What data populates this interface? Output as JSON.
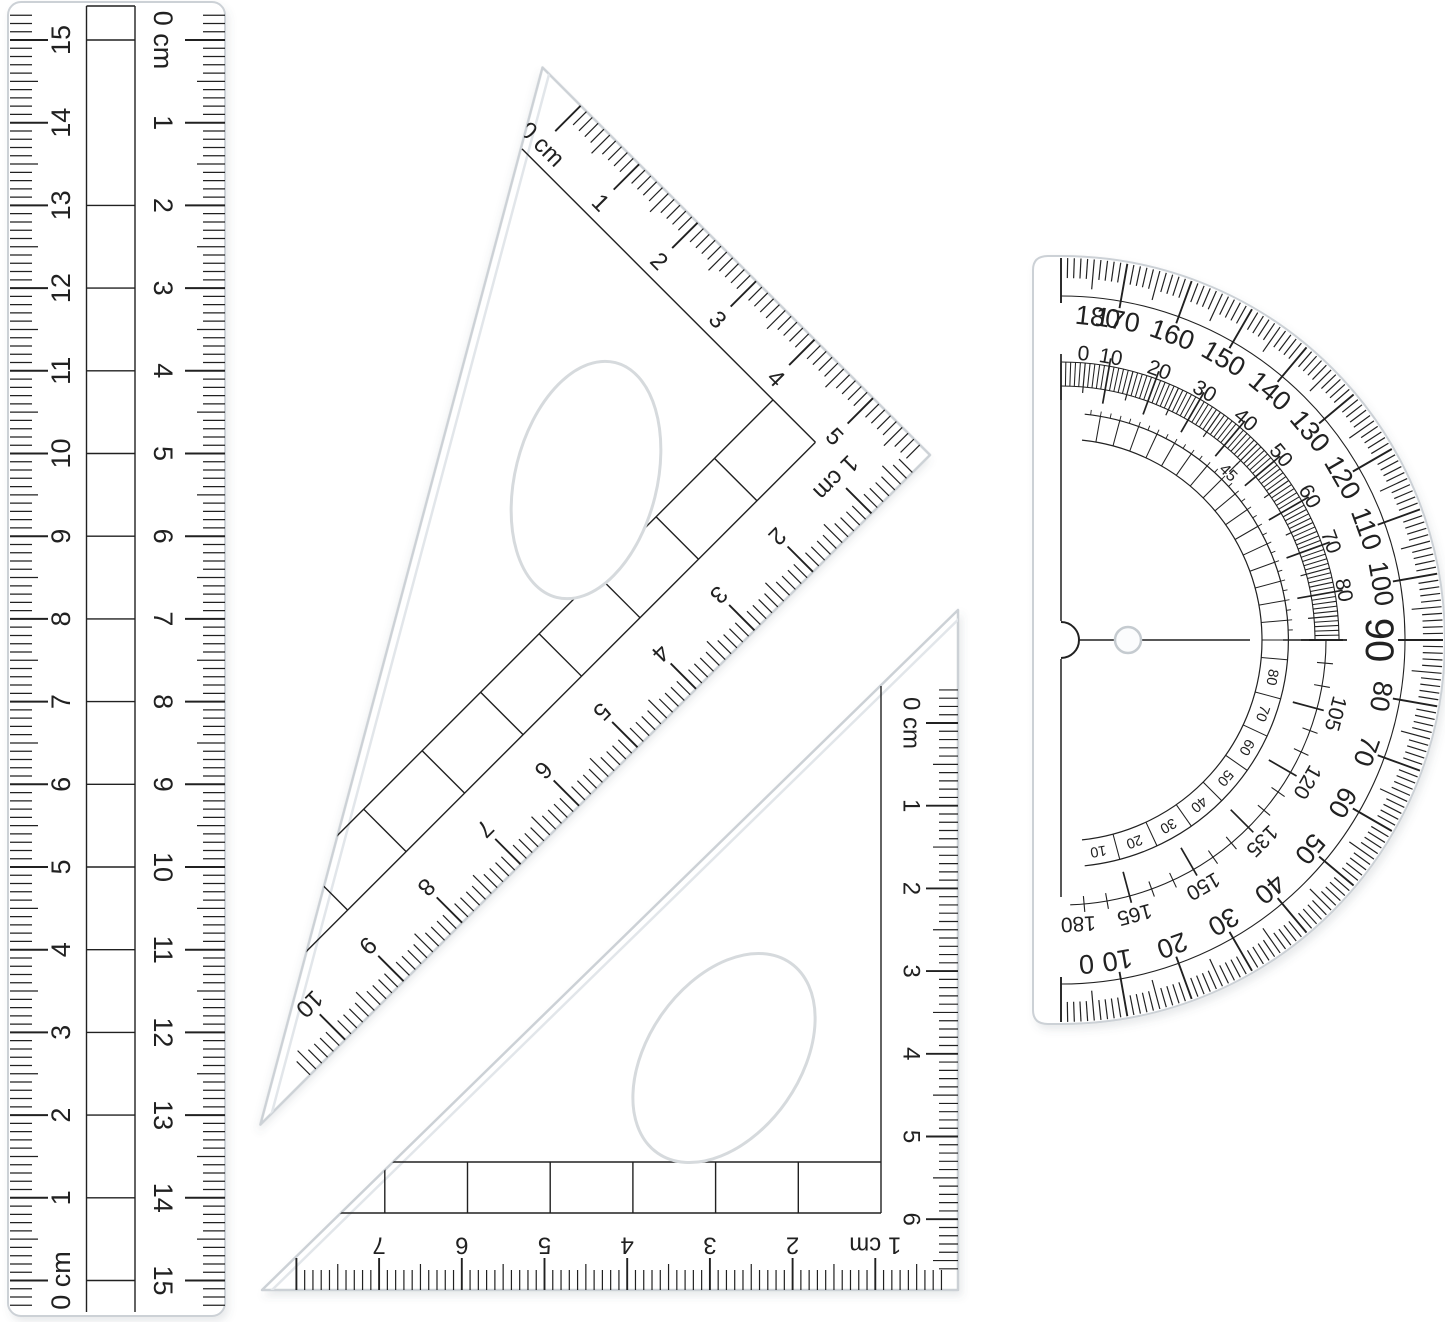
{
  "scene": {
    "type": "product-photo-geometry-set",
    "background": "#ffffff",
    "objects": [
      "ruler-15cm",
      "set-square-30-60",
      "set-square-45",
      "protractor-180"
    ]
  },
  "colors": {
    "marking": "#212121",
    "plastic_edge": "#ccd1d6",
    "bevel": "#e2e6ea",
    "hole_ring": "#c5cbd0",
    "shadow": "#5a6570"
  },
  "ruler": {
    "length_cm": 15,
    "scale_left_labels": [
      "15",
      "14",
      "13",
      "12",
      "11",
      "10",
      "9",
      "8",
      "7",
      "6",
      "5",
      "4",
      "3",
      "2",
      "1",
      "0 cm"
    ],
    "scale_right_labels": [
      "0 cm",
      "1",
      "2",
      "3",
      "4",
      "5",
      "6",
      "7",
      "8",
      "9",
      "10",
      "11",
      "12",
      "13",
      "14",
      "15"
    ]
  },
  "set_square_30_60": {
    "short_edge_labels": [
      "0 cm",
      "1",
      "2",
      "3",
      "4",
      "5"
    ],
    "long_edge_labels": [
      "1 cm",
      "2",
      "3",
      "4",
      "5",
      "6",
      "7",
      "8",
      "9",
      "10"
    ]
  },
  "set_square_45": {
    "vertical_edge_labels": [
      "0 cm",
      "1",
      "2",
      "3",
      "4",
      "5",
      "6"
    ],
    "bottom_edge_labels": [
      "1 cm",
      "2",
      "3",
      "4",
      "5",
      "6",
      "7"
    ]
  },
  "protractor": {
    "outer_scale_upper_labels": [
      "180",
      "170",
      "160",
      "150",
      "140",
      "130",
      "120",
      "110",
      "100"
    ],
    "outer_scale_center_label": "90",
    "outer_scale_lower_labels": [
      "80",
      "70",
      "60",
      "50",
      "40",
      "30",
      "20",
      "10",
      "0"
    ],
    "inner_scale_upper_labels": [
      "0",
      "10",
      "20",
      "30",
      "40",
      "50",
      "60",
      "70",
      "80"
    ],
    "inner_scale_lower_labels": [
      "105",
      "120",
      "135",
      "150",
      "165",
      "180"
    ],
    "fine_scale_top_label": "45",
    "fine_scale_lower_labels": [
      "80",
      "70",
      "60",
      "50",
      "40",
      "30",
      "20",
      "10"
    ]
  }
}
